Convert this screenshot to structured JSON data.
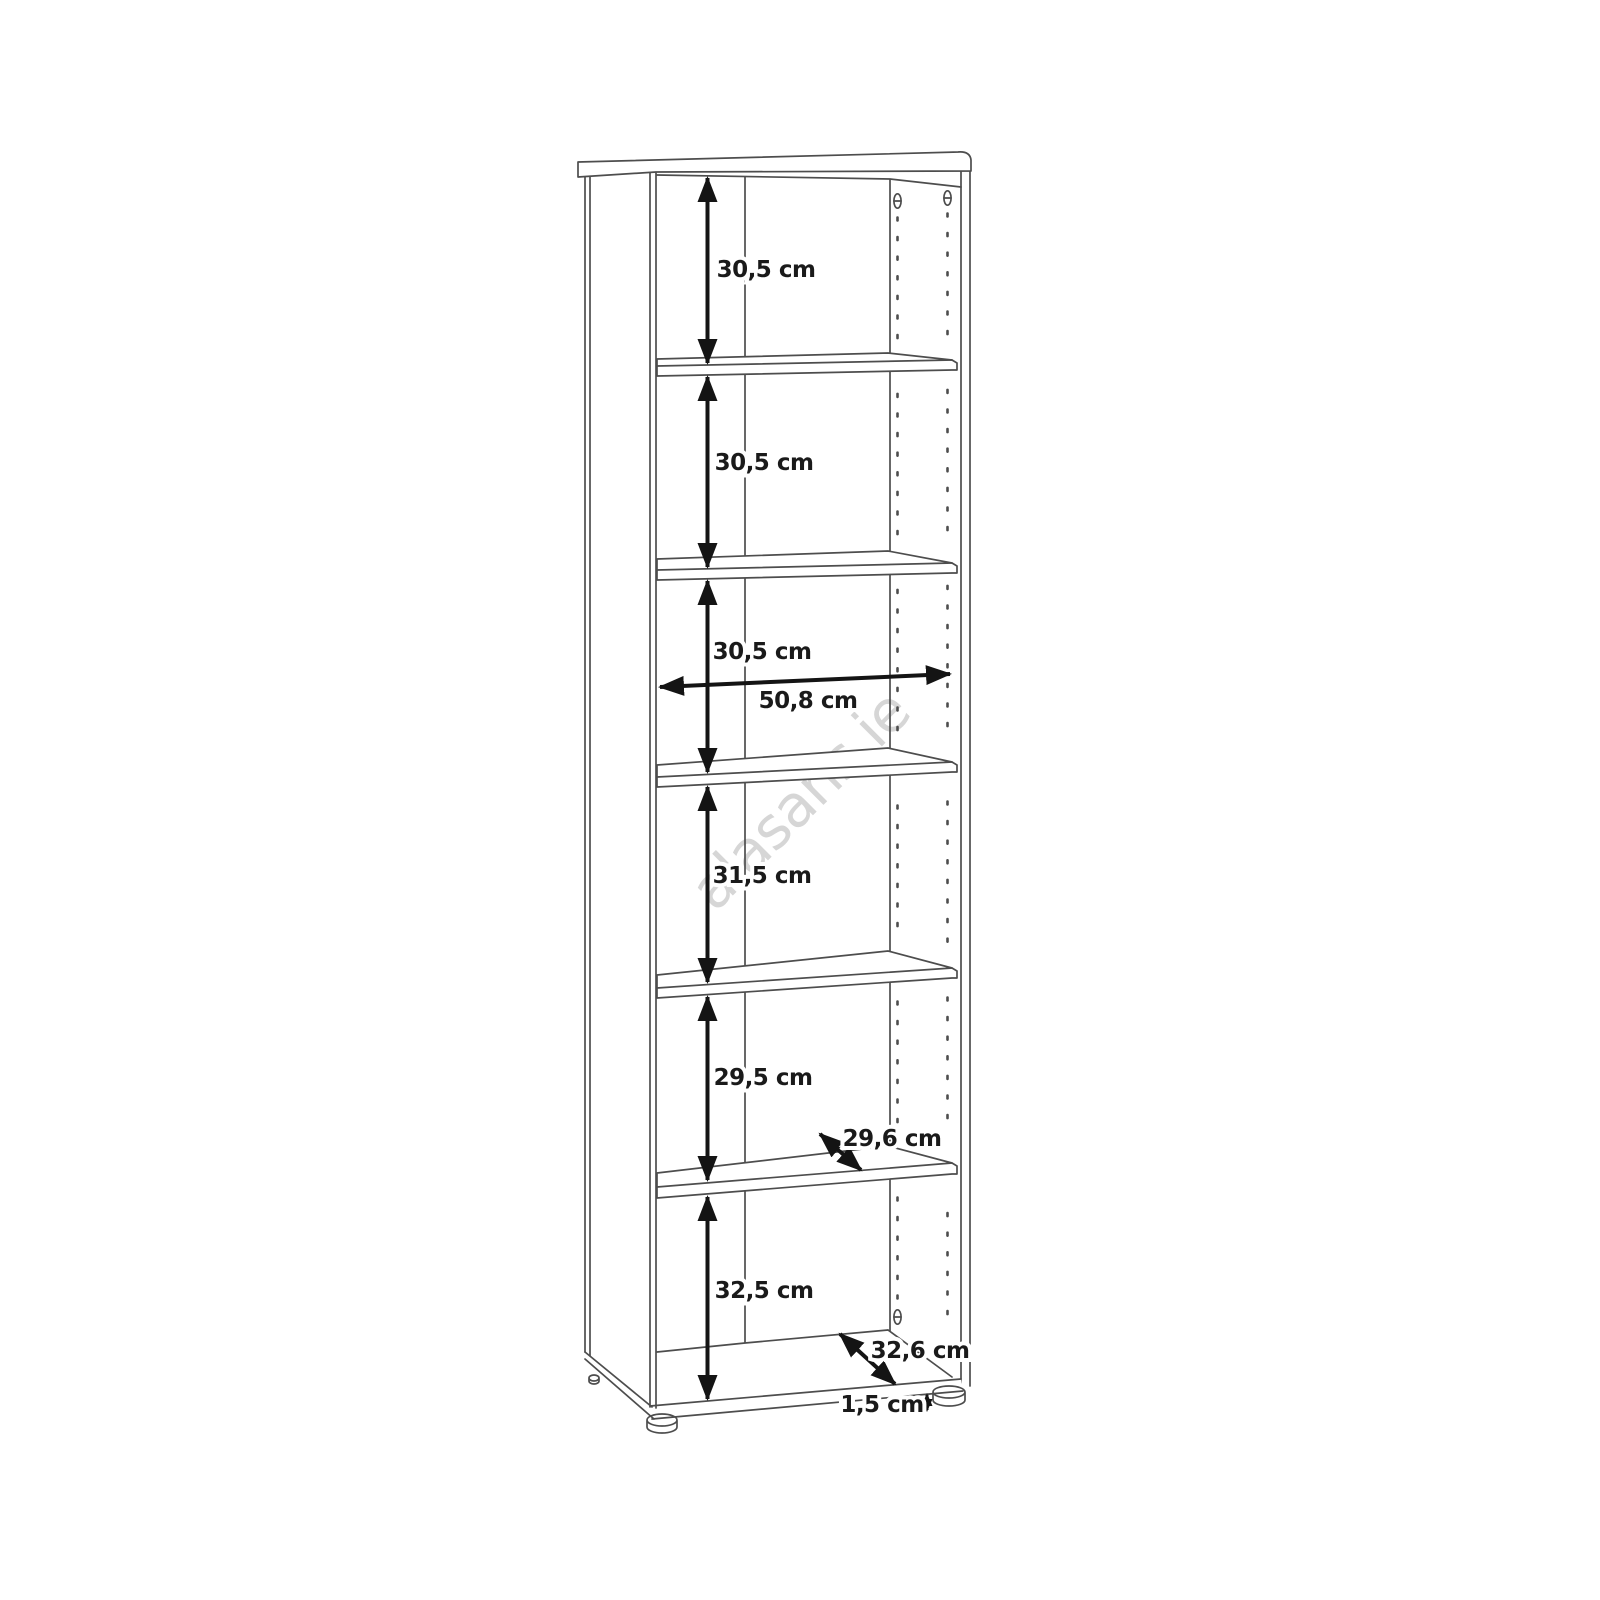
{
  "watermark": {
    "text": "alasans.ie"
  },
  "diagram": {
    "type": "furniture-dimension-line-drawing",
    "subject": "tall open bookcase / shelving unit with 6 compartments",
    "unit": "cm",
    "dimensions": {
      "compartment_1_height": "30,5 cm",
      "compartment_2_height": "30,5 cm",
      "compartment_3_height": "30,5 cm",
      "inner_width": "50,8 cm",
      "compartment_4_height": "31,5 cm",
      "compartment_5_height": "29,5 cm",
      "shelf_depth": "29,6 cm",
      "compartment_6_height": "32,5 cm",
      "base_depth": "32,6 cm",
      "foot_height": "1,5 cm"
    }
  },
  "colors": {
    "background": "#ffffff",
    "structure_line": "#4d4d4d",
    "dimension_line": "#141414",
    "label_text": "#1a1a1a",
    "watermark": "#d6d6d6"
  }
}
